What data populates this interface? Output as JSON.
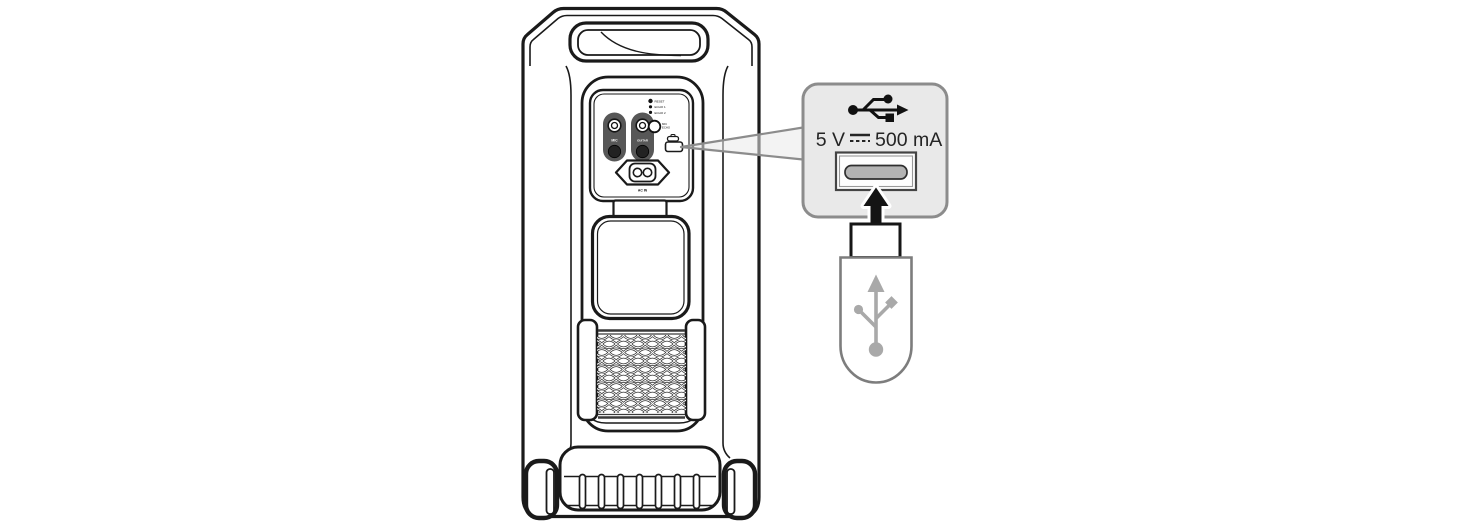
{
  "figure": {
    "kind": "manual-illustration",
    "background": "#ffffff",
    "line_color": "#1a1a1a"
  },
  "speaker": {
    "view": "rear",
    "panel": {
      "mic_jack_label": "MIC",
      "guitar_jack_label": "GUITAR",
      "indicators": [
        "RESET",
        "ECHO 1",
        "ECHO 2"
      ],
      "mic_echo_line1": "MIC",
      "mic_echo_line2": "ECHO",
      "ac_in_label": "AC IN"
    }
  },
  "callout": {
    "rating_voltage": "5 V",
    "rating_current": "500 mA",
    "rating_full_text": "5 V ⎓ 500 mA",
    "fill_color": "#e9e9e9",
    "border_color": "#8c8c8c",
    "slot_color": "#b3b3b3"
  },
  "flash_drive": {
    "symbol": "usb-trident",
    "symbol_color": "#a9a9a9"
  }
}
